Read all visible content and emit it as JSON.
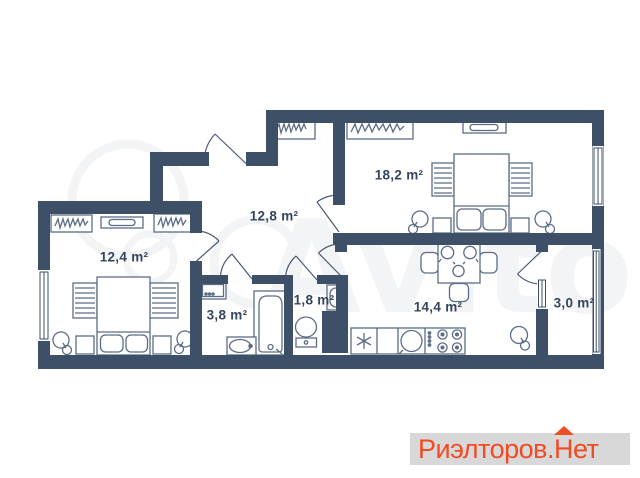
{
  "watermark": {
    "brand": "Avito"
  },
  "logo": {
    "prefix": "Риэлторов.",
    "suffix": "Нет",
    "color": "#f04b23",
    "background": "#d8d8d8"
  },
  "floor_plan": {
    "wall_color": "#3e4f68",
    "furniture_color": "#5c6c86",
    "label_color": "#36455e",
    "rooms": [
      {
        "id": "living-room",
        "area_label": "18,2 m²"
      },
      {
        "id": "hallway",
        "area_label": "12,8 m²"
      },
      {
        "id": "bedroom",
        "area_label": "12,4 m²"
      },
      {
        "id": "bathroom",
        "area_label": "3,8 m²"
      },
      {
        "id": "wc",
        "area_label": "1,8 m²"
      },
      {
        "id": "kitchen",
        "area_label": "14,4 m²"
      },
      {
        "id": "balcony",
        "area_label": "3,0 m²"
      }
    ]
  }
}
